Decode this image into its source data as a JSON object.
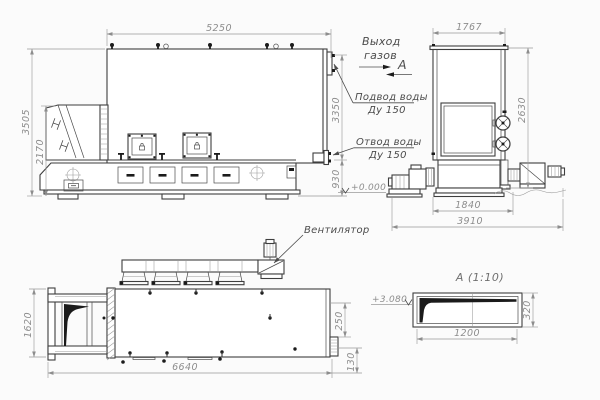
{
  "drawing": {
    "type": "technical-drawing-boiler",
    "colors": {
      "background": "#fbfbfb",
      "line": "#3e3e3e",
      "dim_line": "#9a9a9a",
      "dim_text": "#8d8d8d",
      "label_text": "#4c4c4c",
      "solid_fill": "#1b1b1b"
    },
    "front_view": {
      "dim_width_top": "5250",
      "dim_height_total": "3505",
      "dim_height_hopper": "2170",
      "dim_height_body": "3350",
      "dim_height_base": "930",
      "elevation_zero": "+0.000",
      "label_gas_outlet_line1": "Выход",
      "label_gas_outlet_line2": "газов",
      "label_view_arrow": "А",
      "label_water_supply_line1": "Подвод воды",
      "label_water_supply_line2": "Ду 150",
      "label_water_return_line1": "Отвод воды",
      "label_water_return_line2": "Ду 150"
    },
    "side_view": {
      "dim_width_top": "1767",
      "dim_height": "2630",
      "dim_width_base": "1840",
      "dim_width_total": "3910"
    },
    "plan_view": {
      "dim_height": "1620",
      "dim_length": "6640",
      "dim_offset_upper": "250",
      "dim_offset_lower": "130",
      "label_fan": "Вентилятор"
    },
    "detail_view": {
      "title": "А  (1:10)",
      "dim_width": "1200",
      "dim_height": "320",
      "elevation": "+3.080"
    }
  }
}
